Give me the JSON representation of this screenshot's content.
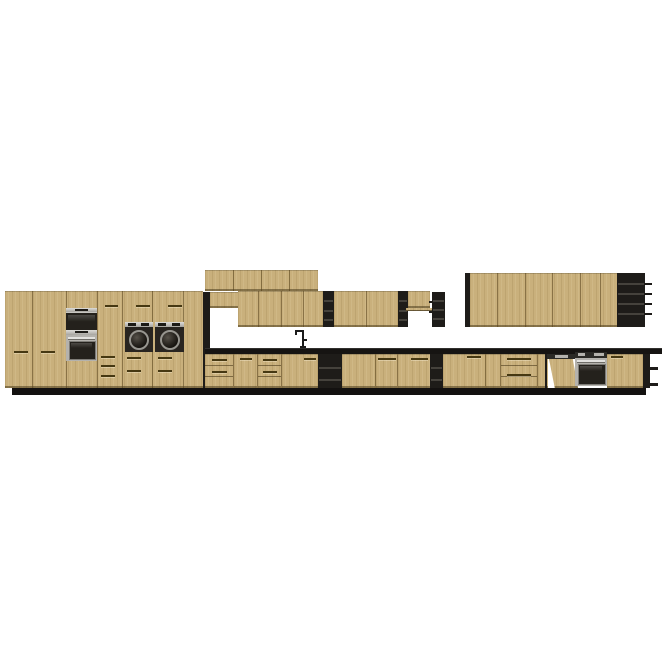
{
  "title": "Kitchen cabinet set – front elevation product image",
  "background": "#ffffff",
  "colors": {
    "background": "#ffffff",
    "wood": "#c9b07c",
    "wood_grain_dark": "#7a5f2d",
    "wood_grain_light": "#e8d6a4",
    "carcass_black": "#1e1c19",
    "countertop": "#161412",
    "plinth": "#131110",
    "steel": "#b4b2ad",
    "appliance_glass": "#24211c",
    "handle_slot": "#463812",
    "shelf_highlight": "#45423c"
  },
  "scene": {
    "style": "flat-panel light oak fronts with black carcass and black open shelving",
    "view": "straight-on front elevation on plain white background",
    "tall_unit": {
      "doors": 5,
      "drawer_fronts": 3,
      "appliances": [
        "built-in double oven (stacked)",
        "two front-loading laundry appliances with round glass doors"
      ]
    },
    "wall_cabinets": {
      "stacked_top_row_doors": 4,
      "mid_row_doors": 5,
      "short_cabinets": 2,
      "right_run_doors": 6,
      "black_open_shelf_units": 4
    },
    "base_cabinets": {
      "door_fronts": 9,
      "drawer_stacks": 3,
      "black_open_shelf_units": 2,
      "appliances": [
        "panel-ready dishwasher with door ajar",
        "built-in stainless oven"
      ]
    },
    "fixtures": [
      "single-lever sink mixer tap"
    ],
    "worktop": "slim black worktop across base run",
    "plinth": "recessed black plinth"
  }
}
